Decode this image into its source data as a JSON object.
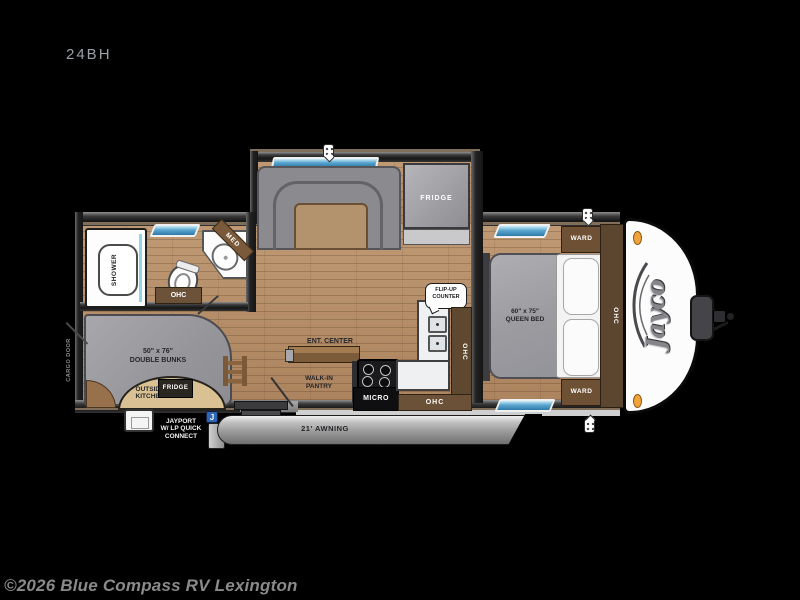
{
  "title": {
    "model": "24BH"
  },
  "watermark": {
    "text": "©2026 Blue Compass RV Lexington"
  },
  "colors": {
    "background": "#000000",
    "floor_wood": "#b5916c",
    "wall_dark": "#2a2a2a",
    "trim_tan": "#7f6e59",
    "upholstery_gray": "#96969a",
    "cabinet_brown": "#6b5137",
    "counter_white": "#eef0f1",
    "window_blue": "#3584b5",
    "awning_gray": "#9b9b9b",
    "marker_orange": "#f2a23a",
    "jayport_blue": "#2f66b5",
    "watermark_gray": "#8a8a8a"
  },
  "icons": {
    "speaker_pin": "speaker-pin-icon",
    "jayport_badge_letter": "J"
  },
  "floorplan": {
    "slide": {
      "fridge": "FRIDGE"
    },
    "bathroom": {
      "shower": "SHOWER",
      "med": "MED",
      "ohc": "OHC"
    },
    "bunks": {
      "size": "50\" x 76\"",
      "name": "DOUBLE BUNKS",
      "cargo_door": "CARGO DOOR"
    },
    "outside_kitchen": {
      "line1": "OUTSIDE",
      "line2": "KITCHEN",
      "fridge": "FRIDGE"
    },
    "jayport": {
      "line1": "JAYPORT",
      "line2": "W/ LP QUICK",
      "line3": "CONNECT"
    },
    "awning": {
      "label": "21' AWNING"
    },
    "galley": {
      "ent_center": "ENT. CENTER",
      "pantry_line1": "WALK-IN",
      "pantry_line2": "PANTRY",
      "micro": "MICRO",
      "flip_line1": "FLIP-UP",
      "flip_line2": "COUNTER",
      "ohc_side": "OHC",
      "ohc_bottom": "OHC"
    },
    "bedroom": {
      "size": "60\" x 75\"",
      "name": "QUEEN BED",
      "ward_top": "WARD",
      "ward_bottom": "WARD",
      "ohc_front": "OHC"
    },
    "front": {
      "brand": "Jayco"
    }
  }
}
